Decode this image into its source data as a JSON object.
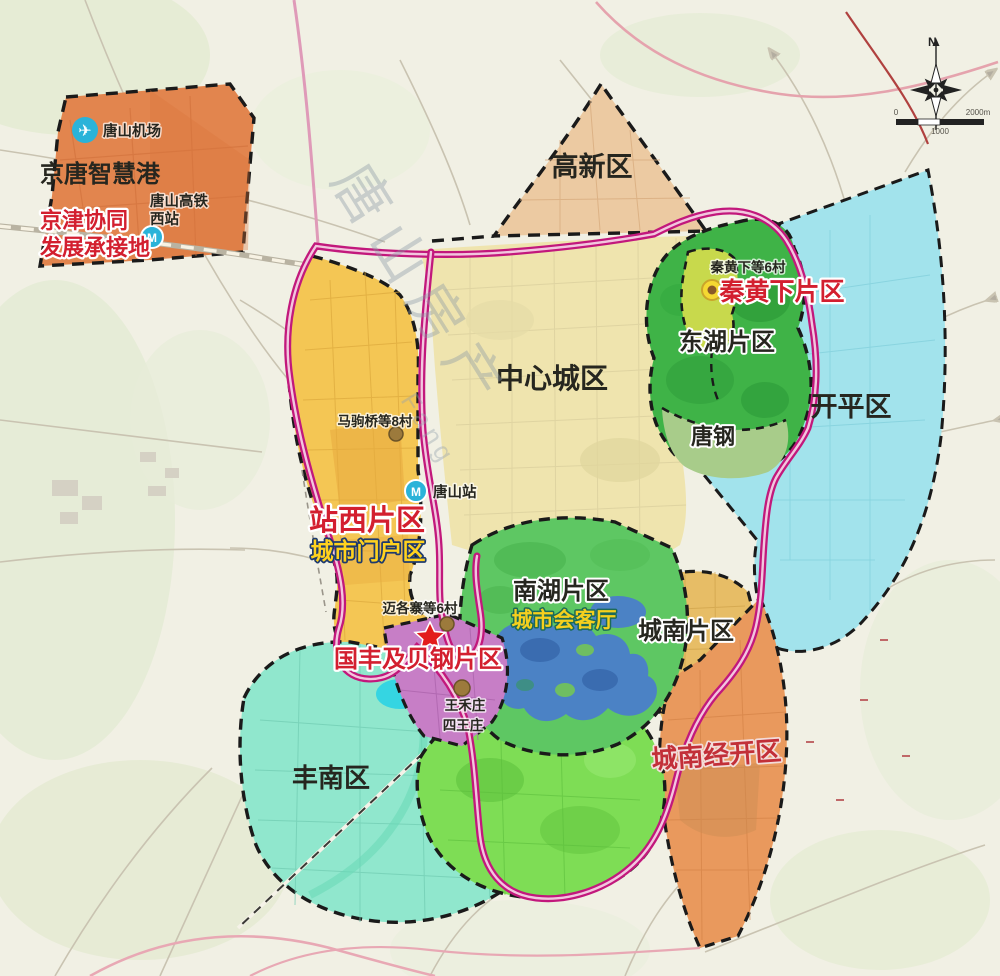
{
  "map_title": "唐山市中心城区片区规划示意图",
  "districts": [
    {
      "id": "jingtang-smart-port",
      "label": "京唐智慧港",
      "color": "#e2854e"
    },
    {
      "id": "gaoxin",
      "label": "高新区",
      "color": "#eccaa2"
    },
    {
      "id": "central-city",
      "label": "中心城区",
      "color": "#efe4ae"
    },
    {
      "id": "zhanxi",
      "label": "站西片区",
      "color": "#f4c654",
      "label_color": "#d31f2f"
    },
    {
      "id": "donghu",
      "label": "东湖片区",
      "color": "#3fb347"
    },
    {
      "id": "tanggang",
      "label": "唐钢",
      "color": "#a8cc8a"
    },
    {
      "id": "qinhuangxia",
      "label": "秦黄下片区",
      "color": "#c8d94c",
      "label_color": "#d31f2f"
    },
    {
      "id": "kaiping",
      "label": "开平区",
      "color": "#a2e3ec"
    },
    {
      "id": "nanhu",
      "label": "南湖片区",
      "color": "#5ec763"
    },
    {
      "id": "chengnan",
      "label": "城南片区",
      "color": "#e7bd66"
    },
    {
      "id": "chengnan-jingkai",
      "label": "城南经开区",
      "color": "#e9995d",
      "label_color": "#c22f38"
    },
    {
      "id": "fengnan",
      "label": "丰南区",
      "color": "#90e7cd"
    },
    {
      "id": "guofeng-beigang",
      "label": "国丰及贝钢片区",
      "color": "#c77ec6",
      "label_color": "#d31f2f"
    }
  ],
  "sub_labels": {
    "airport": "唐山机场",
    "hsr_west_line1": "唐山高铁",
    "hsr_west_line2": "西站",
    "jingjin_line1": "京津协同",
    "jingjin_line2": "发展承接地",
    "majuqiao_villages": "马驹桥等8村",
    "tangshan_station": "唐山站",
    "city_gateway": "城市门户区",
    "maigezhai_villages": "迈各寨等6村",
    "wanghezhuang": "王禾庄",
    "siwangzhuang": "四王庄",
    "city_parlor": "城市会客厅",
    "qinhuangxia_villages": "秦黄下等6村"
  },
  "compass": {
    "north_label": "N"
  },
  "scale_bar": {
    "labels": [
      "0",
      "1000",
      "2000m"
    ]
  },
  "watermark": {
    "cn": "唐山房产",
    "en": "Fang"
  },
  "colors": {
    "ring_road": "#c2187c",
    "ring_road_inner": "#f2c6de",
    "red_label": "#d31f2f",
    "gold_label": "#ffd21e",
    "lake_blue": "#4b82c5",
    "border_dash": "#1a1a1a"
  }
}
